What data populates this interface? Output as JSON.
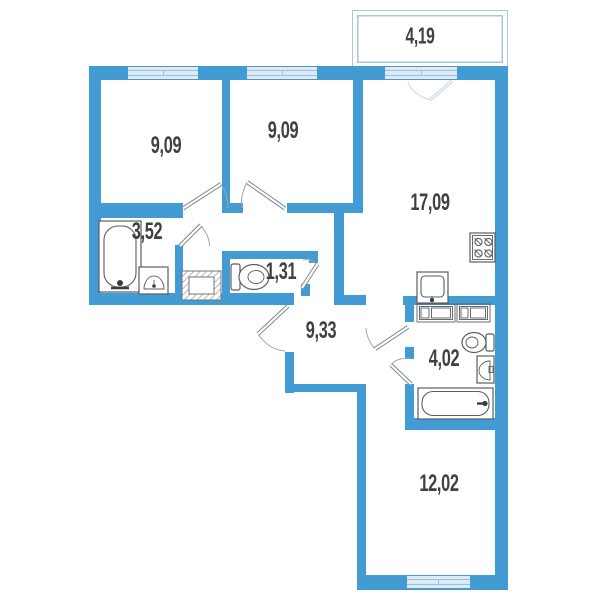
{
  "plan_title": "3-room apartment floor plan",
  "units": "m2",
  "rooms": [
    {
      "id": "balcony",
      "label": "4,19"
    },
    {
      "id": "bedroom-1",
      "label": "9,09"
    },
    {
      "id": "bedroom-2",
      "label": "9,09"
    },
    {
      "id": "kitchen-living",
      "label": "17,09"
    },
    {
      "id": "bathroom",
      "label": "3,52"
    },
    {
      "id": "wc",
      "label": "1,31"
    },
    {
      "id": "hallway",
      "label": "9,33"
    },
    {
      "id": "bathroom-2",
      "label": "4,02"
    },
    {
      "id": "room-3",
      "label": "12,02"
    }
  ],
  "fixtures": [
    "bathtub-vertical",
    "sink-bathroom",
    "wardrobe-hatched",
    "toilet-wc",
    "stove-4-burner",
    "kitchen-sink",
    "cabinet-row",
    "toilet-bathroom-2",
    "sink-bathroom-2",
    "bathtub-horizontal"
  ],
  "colors": {
    "wall": "#429BD2",
    "winfill": "#DEEAF5",
    "winline": "#9FBFD9",
    "balconyline": "#A9C6DE",
    "fixture": "#5B5E61",
    "fixturedark": "#3A3D40",
    "ink": "#3E4144",
    "door": "#83888D",
    "doorarc": "#A0A6AB",
    "doorlight": "#B3CCE2",
    "doorlightarc": "#C3D7E8"
  }
}
